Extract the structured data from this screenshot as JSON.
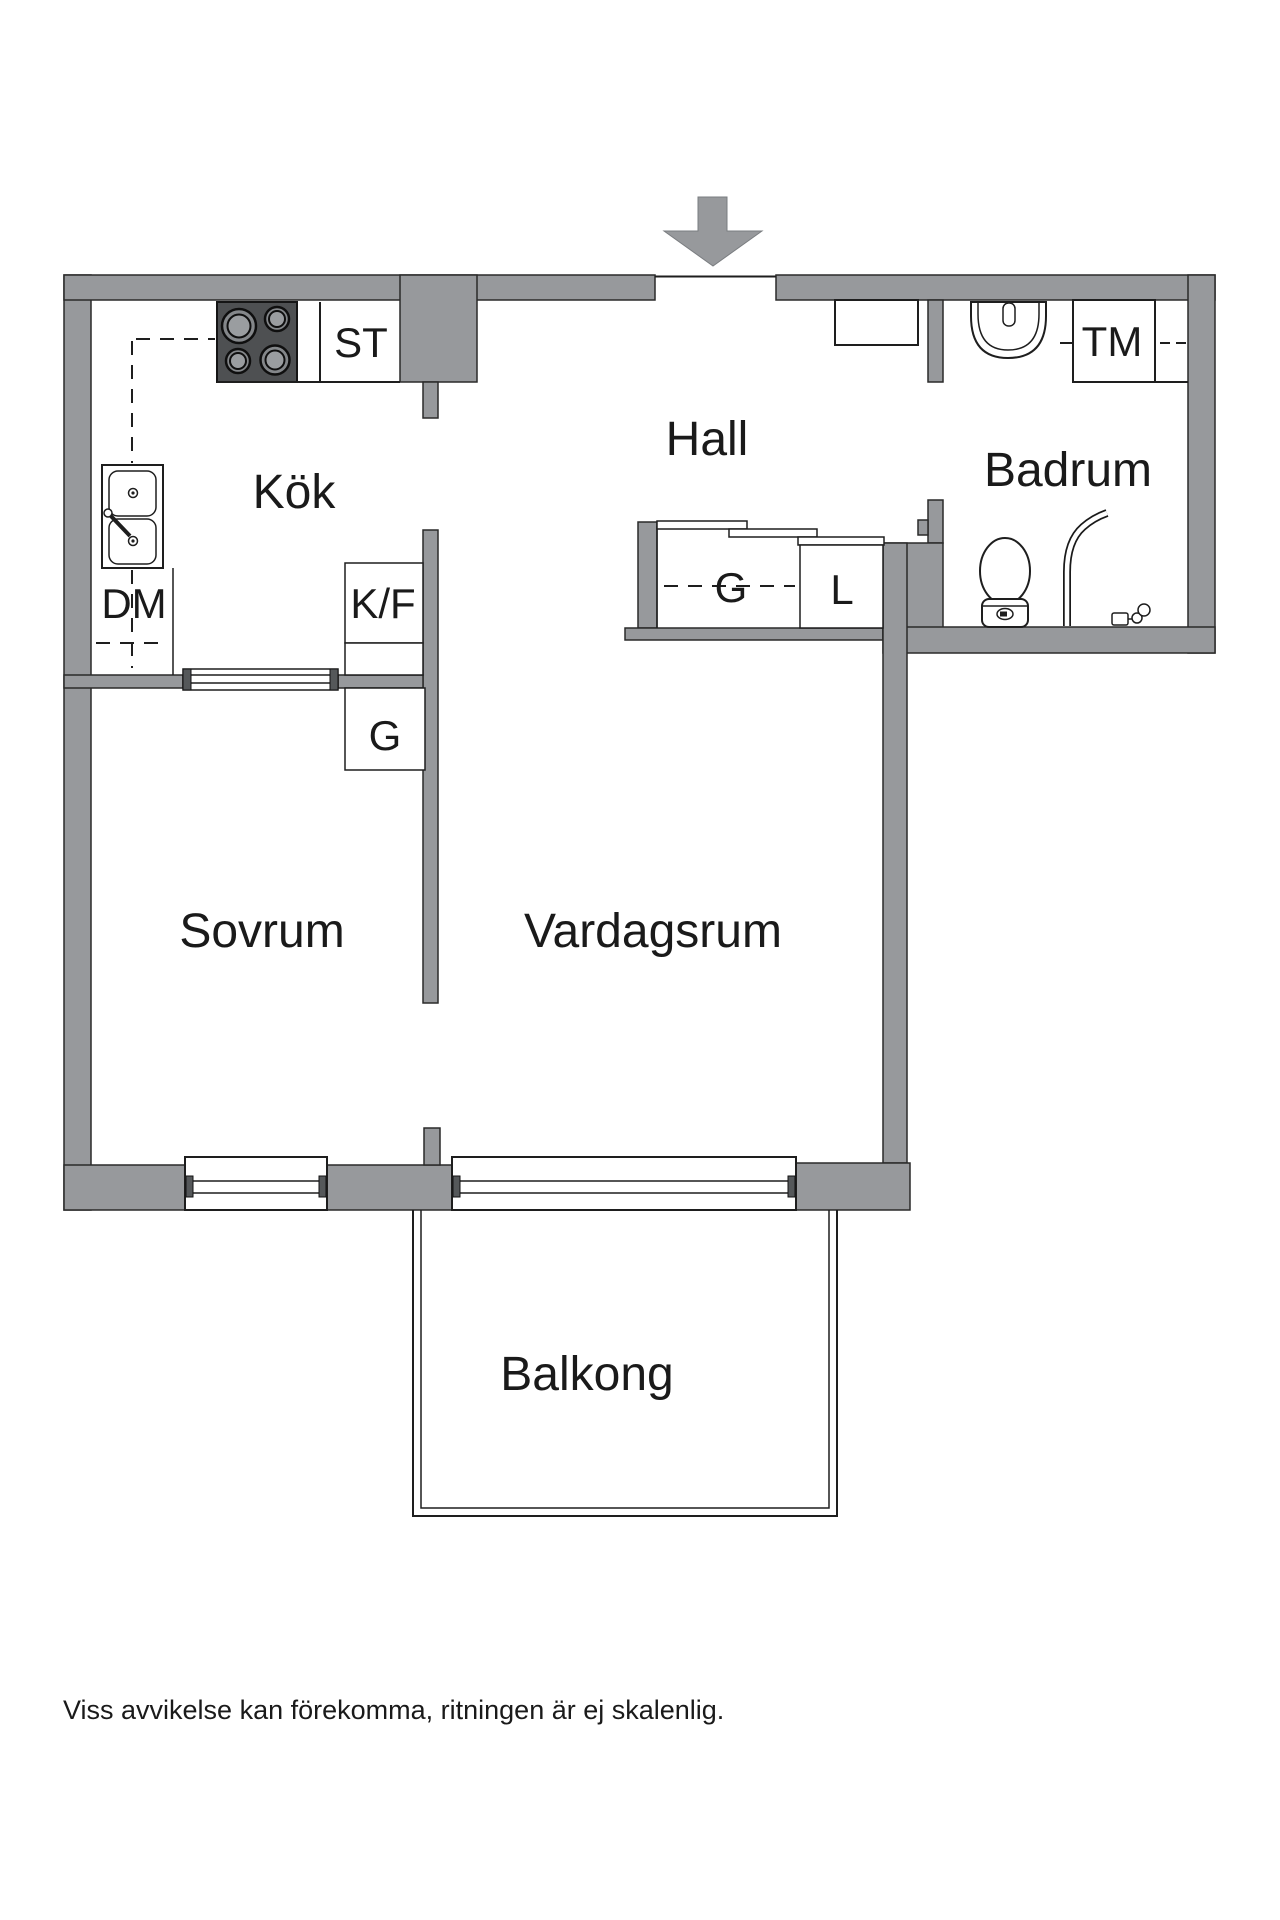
{
  "meta": {
    "type": "apartment-floor-plan"
  },
  "colors": {
    "wall": "#97999c",
    "stove": "#4e5052",
    "outline": "#1e1e1e",
    "text": "#1a1a1a",
    "background": "#ffffff"
  },
  "rooms": {
    "kok": {
      "label": "Kök"
    },
    "hall": {
      "label": "Hall"
    },
    "badrum": {
      "label": "Badrum"
    },
    "sovrum": {
      "label": "Sovrum"
    },
    "vardagsrum": {
      "label": "Vardagsrum"
    },
    "balkong": {
      "label": "Balkong"
    }
  },
  "fixtures": {
    "st": {
      "label": "ST"
    },
    "dm": {
      "label": "DM"
    },
    "kf": {
      "label": "K/F"
    },
    "g_kok": {
      "label": "G"
    },
    "g_hall": {
      "label": "G"
    },
    "l_hall": {
      "label": "L"
    },
    "tm": {
      "label": "TM"
    }
  },
  "footer": {
    "disclaimer": "Viss avvikelse kan förekomma, ritningen är ej skalenlig."
  }
}
